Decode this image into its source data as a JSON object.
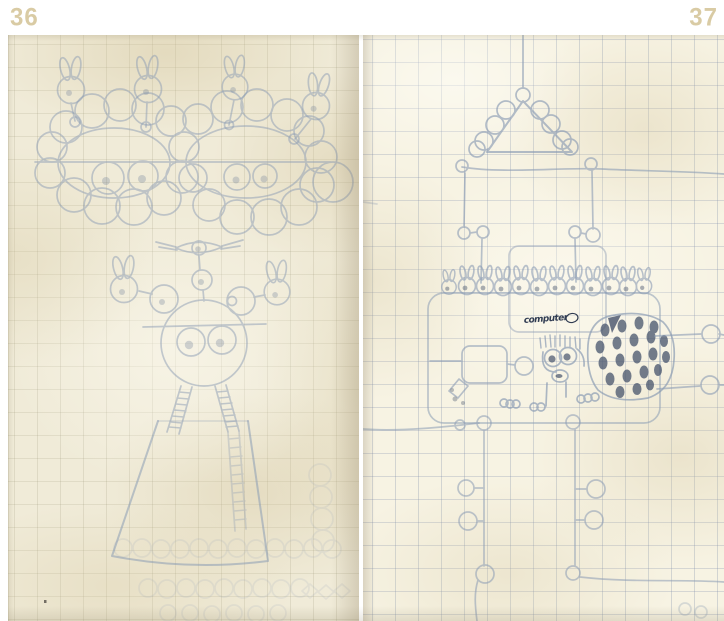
{
  "pages": {
    "left": {
      "number": "36"
    },
    "right": {
      "number": "37",
      "annotation": "computer"
    }
  },
  "colors": {
    "page_number": "#d9cba4",
    "pencil": "#8b9cb4",
    "pencil_dark": "#46536b",
    "ink_annotation": "#303c52"
  }
}
